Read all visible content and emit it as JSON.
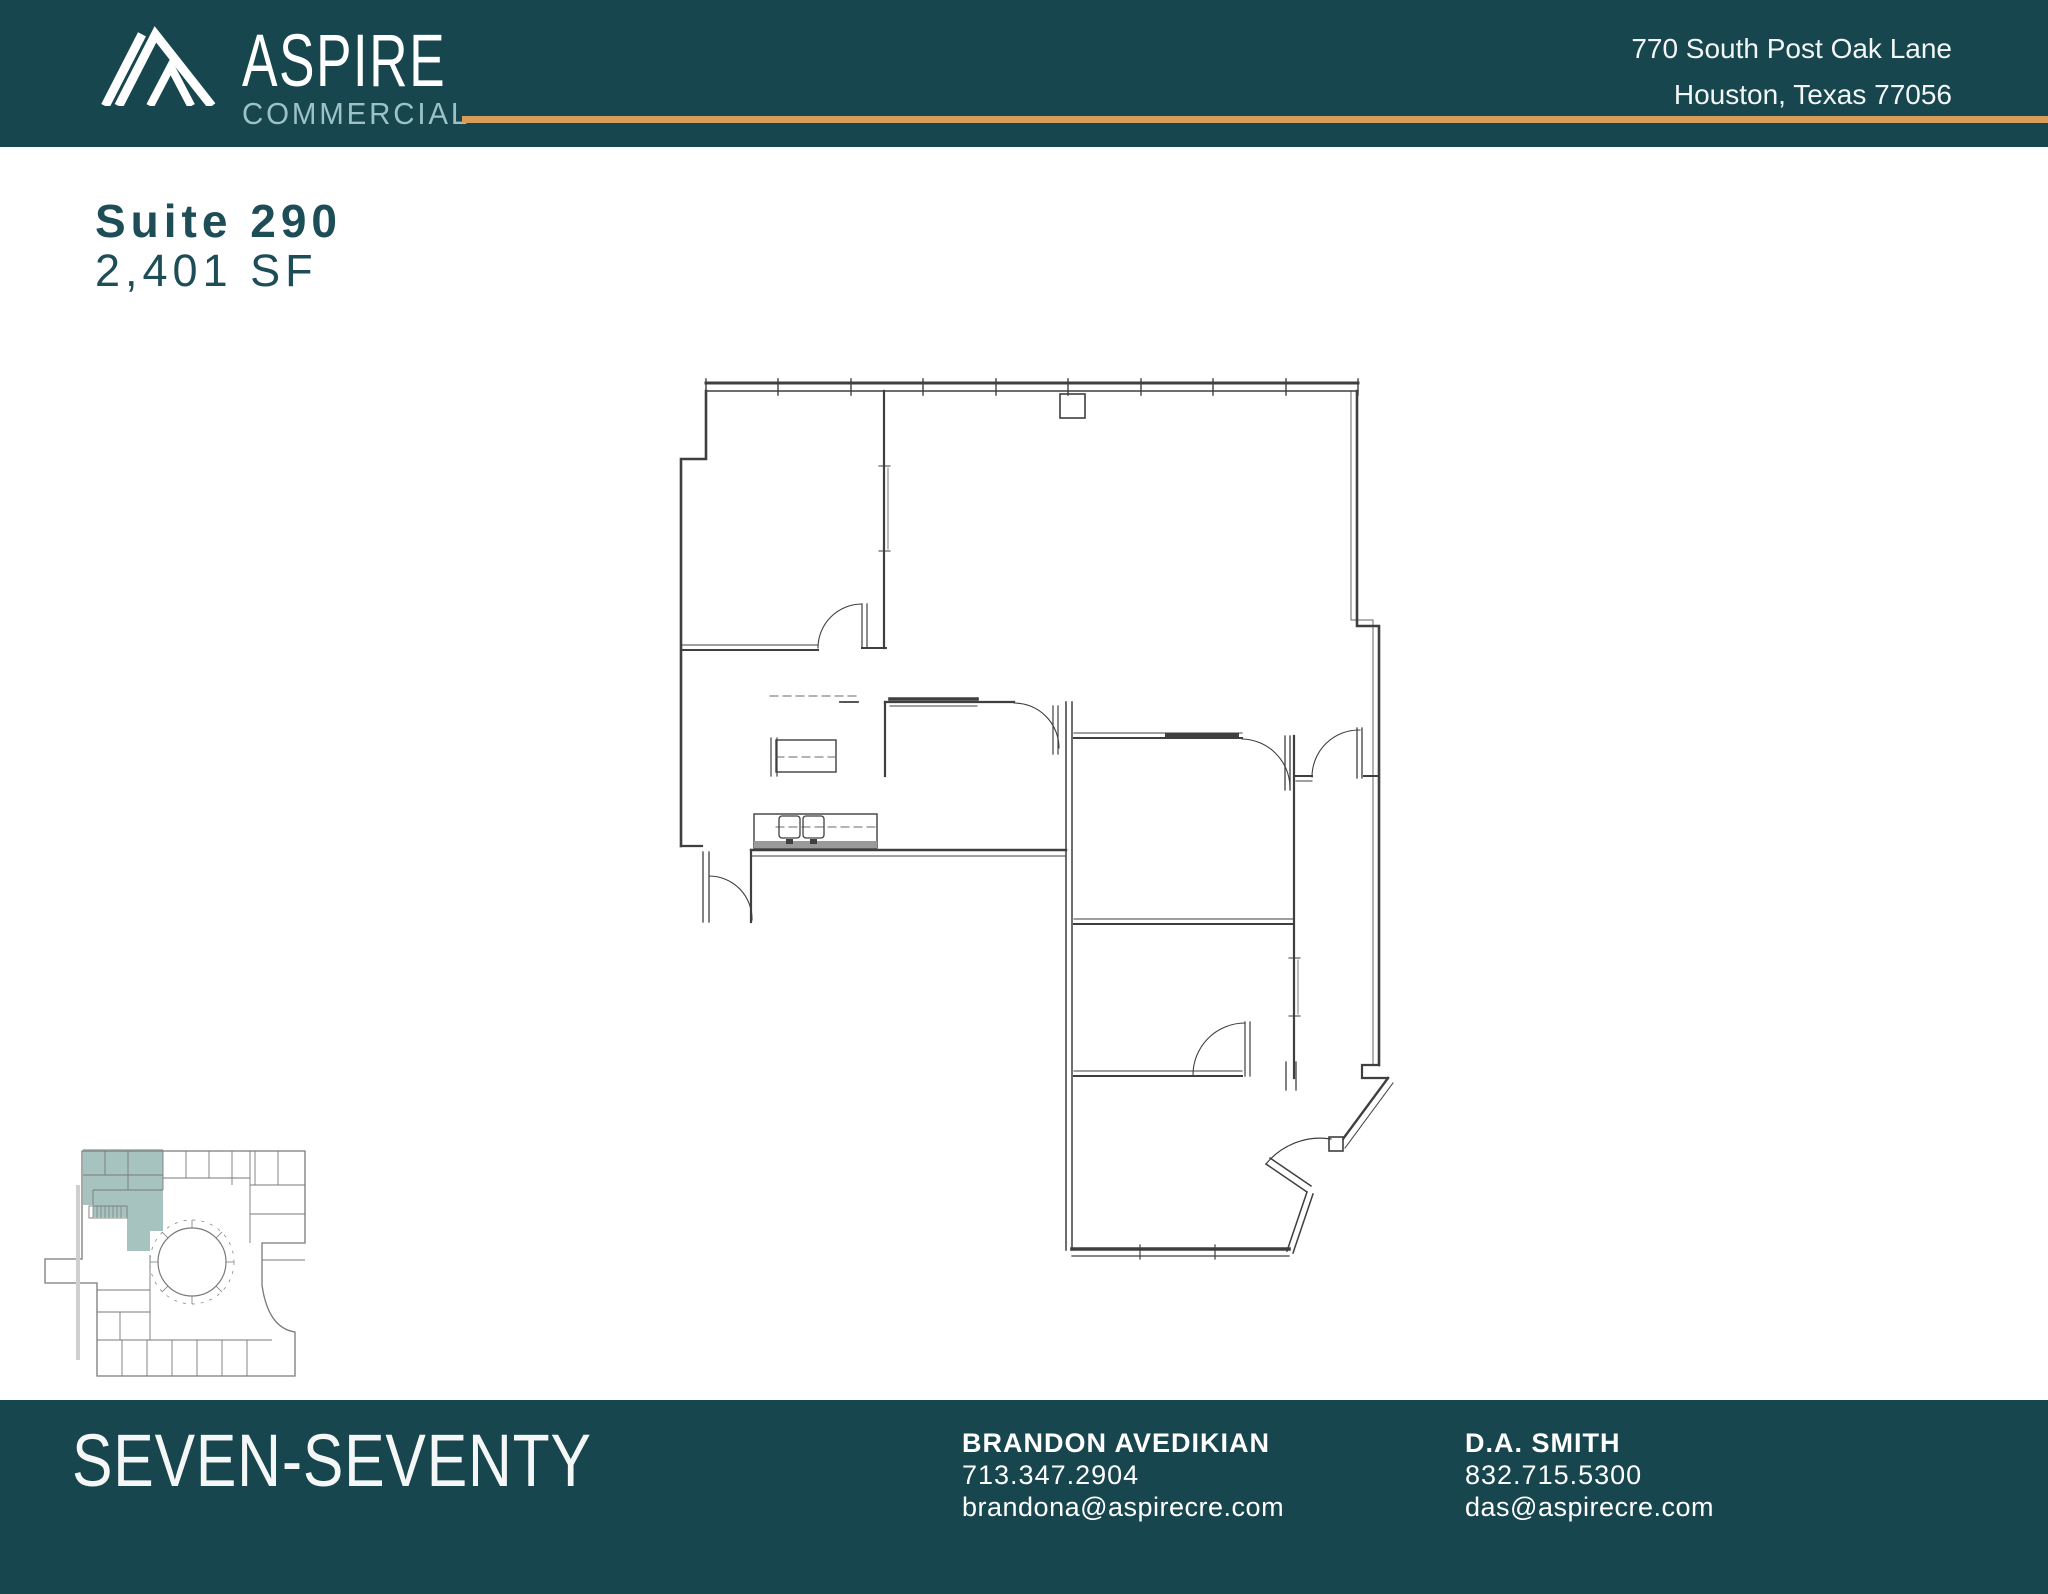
{
  "colors": {
    "teal": "#17464e",
    "gold": "#d89d58",
    "logo_light": "#9cc2c8",
    "title_teal": "#1d4d57",
    "suite_highlight": "#a6c3bf"
  },
  "header": {
    "brand": {
      "name": "ASPIRE",
      "subname": "COMMERCIAL"
    },
    "address_line1": "770 South Post Oak Lane",
    "address_line2": "Houston, Texas 77056"
  },
  "suite": {
    "title": "Suite 290",
    "area": "2,401 SF"
  },
  "footer": {
    "building": "SEVEN-SEVENTY",
    "contacts": [
      {
        "name": "BRANDON AVEDIKIAN",
        "phone": "713.347.2904",
        "email": "brandona@aspirecre.com"
      },
      {
        "name": "D.A. SMITH",
        "phone": "832.715.5300",
        "email": "das@aspirecre.com"
      }
    ]
  }
}
